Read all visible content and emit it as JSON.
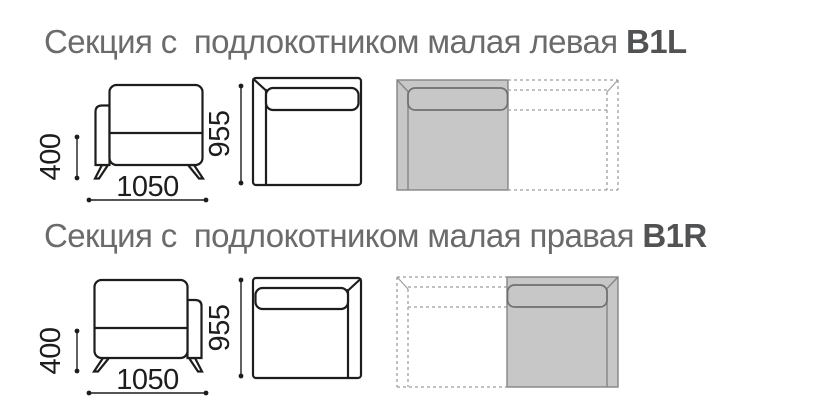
{
  "page": {
    "background": "#ffffff"
  },
  "sections": [
    {
      "code": "B1L",
      "title": "Секция с  подлокотником малая левая ",
      "description": "Section with armrest, small, left",
      "armrest_side": "left",
      "dims": {
        "seat_height": "400",
        "width": "1050",
        "depth": "955"
      }
    },
    {
      "code": "B1R",
      "title": "Секция с  подлокотником малая правая ",
      "description": "Section with armrest, small, right",
      "armrest_side": "right",
      "dims": {
        "seat_height": "400",
        "width": "1050",
        "depth": "955"
      }
    }
  ],
  "colors": {
    "line": "#1d1d1b",
    "title_text": "#6a6b6d",
    "code_text": "#515254",
    "plan_fill": "#c7c7c7",
    "plan_outline": "#858585",
    "dashed_outline": "#9e9e9e"
  }
}
